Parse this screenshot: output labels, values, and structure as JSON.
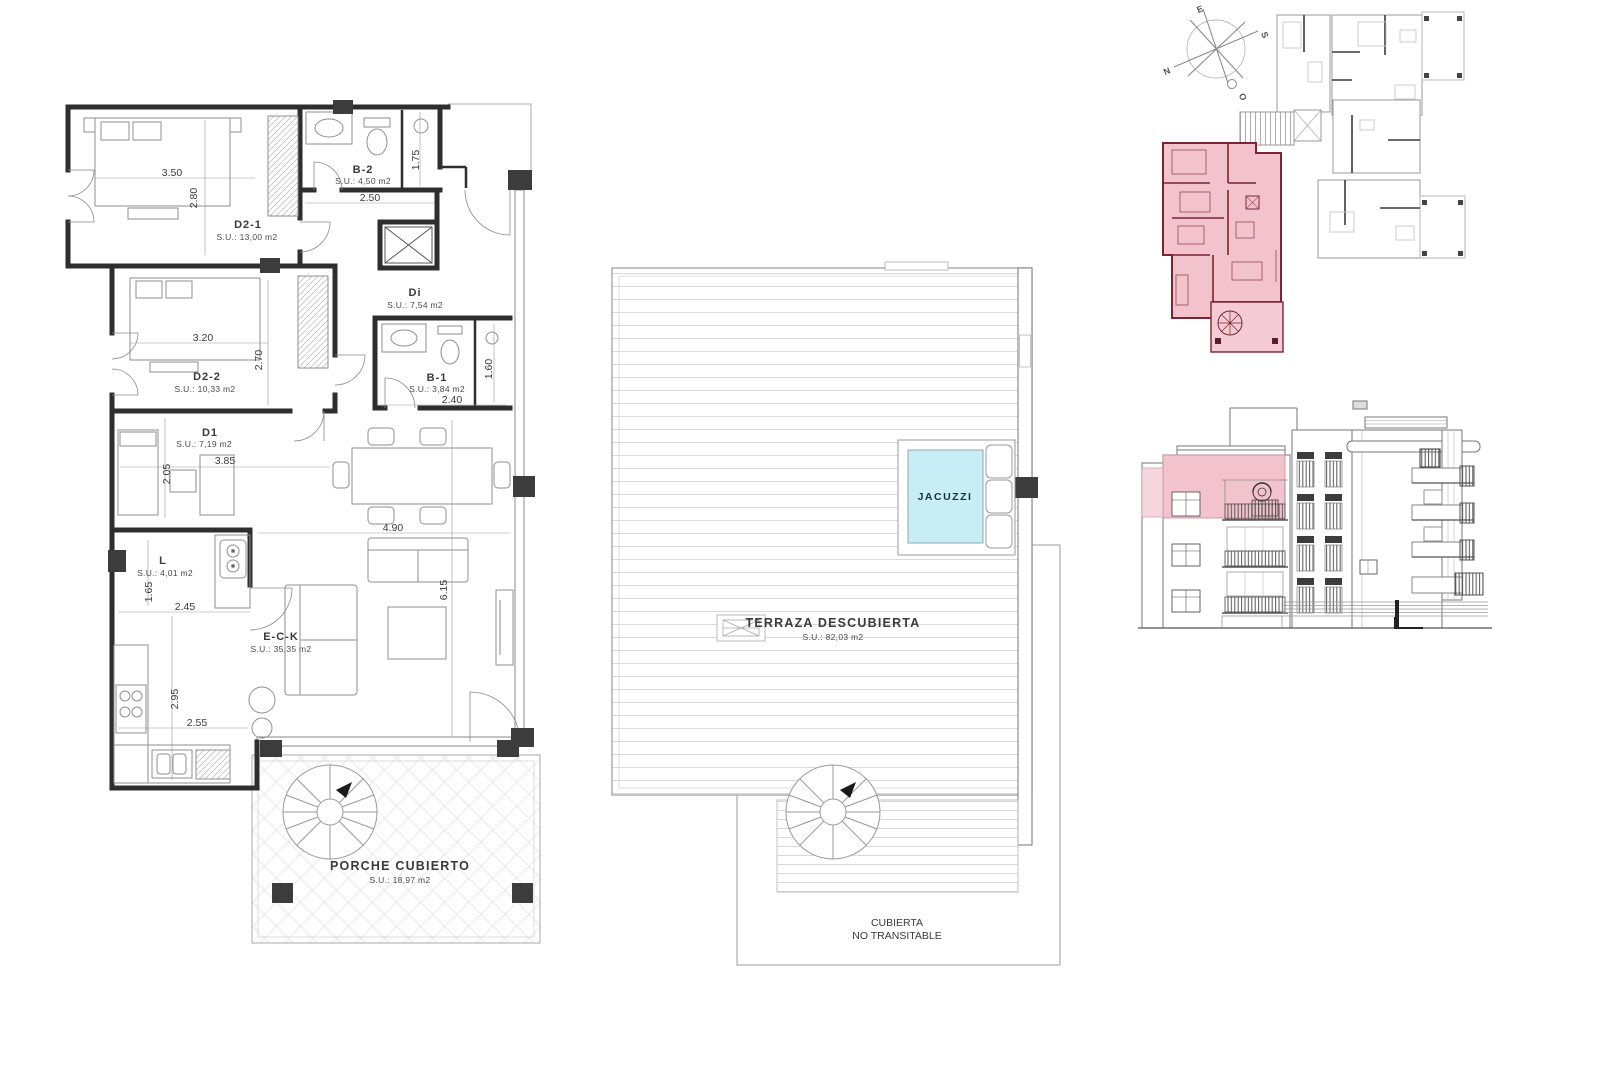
{
  "colors": {
    "highlight_pink": "#f3c3cd",
    "highlight_pink_light": "#f6d6dd",
    "highlight_wall_red": "#7b2433",
    "jacuzzi_blue": "#c9edf5",
    "wall_dark": "#2e2e2e",
    "line_gray": "#9a9a9a"
  },
  "floor_plan": {
    "rooms": {
      "d21": {
        "name": "D2-1",
        "area": "S.U.: 13,00 m2",
        "dim_w": "3.50",
        "dim_h": "2.80"
      },
      "b2": {
        "name": "B-2",
        "area": "S.U.: 4,50 m2",
        "dim_w": "2.50",
        "dim_h": "1.75"
      },
      "d22": {
        "name": "D2-2",
        "area": "S.U.: 10,33 m2",
        "dim_w": "3.20",
        "dim_h": "2.70"
      },
      "di": {
        "name": "Di",
        "area": "S.U.: 7,54 m2"
      },
      "b1": {
        "name": "B-1",
        "area": "S.U.: 3,84 m2",
        "dim_w": "2.40",
        "dim_h": "1.60"
      },
      "d1": {
        "name": "D1",
        "area": "S.U.: 7,19 m2",
        "dim_w": "3.85",
        "dim_h": "2.05"
      },
      "l": {
        "name": "L",
        "area": "S.U.: 4,01 m2",
        "dim_w": "2.45",
        "dim_h": "1.65"
      },
      "eck": {
        "name": "E-C-K",
        "area": "S.U.: 35,35 m2",
        "dim_w": "4.90",
        "dim_h": "6.15"
      },
      "kitchen": {
        "dim_w": "2.55",
        "dim_h": "2.95"
      },
      "porche": {
        "name": "PORCHE CUBIERTO",
        "area": "S.U.: 18,97 m2"
      }
    }
  },
  "terrace_plan": {
    "jacuzzi": "JACUZZI",
    "terraza_name": "TERRAZA DESCUBIERTA",
    "terraza_area": "S.U.: 82,03 m2",
    "cubierta_line1": "CUBIERTA",
    "cubierta_line2": "NO TRANSITABLE"
  },
  "site_plan": {
    "compass": {
      "e": "E",
      "s": "S",
      "n": "N",
      "o": "O"
    }
  }
}
